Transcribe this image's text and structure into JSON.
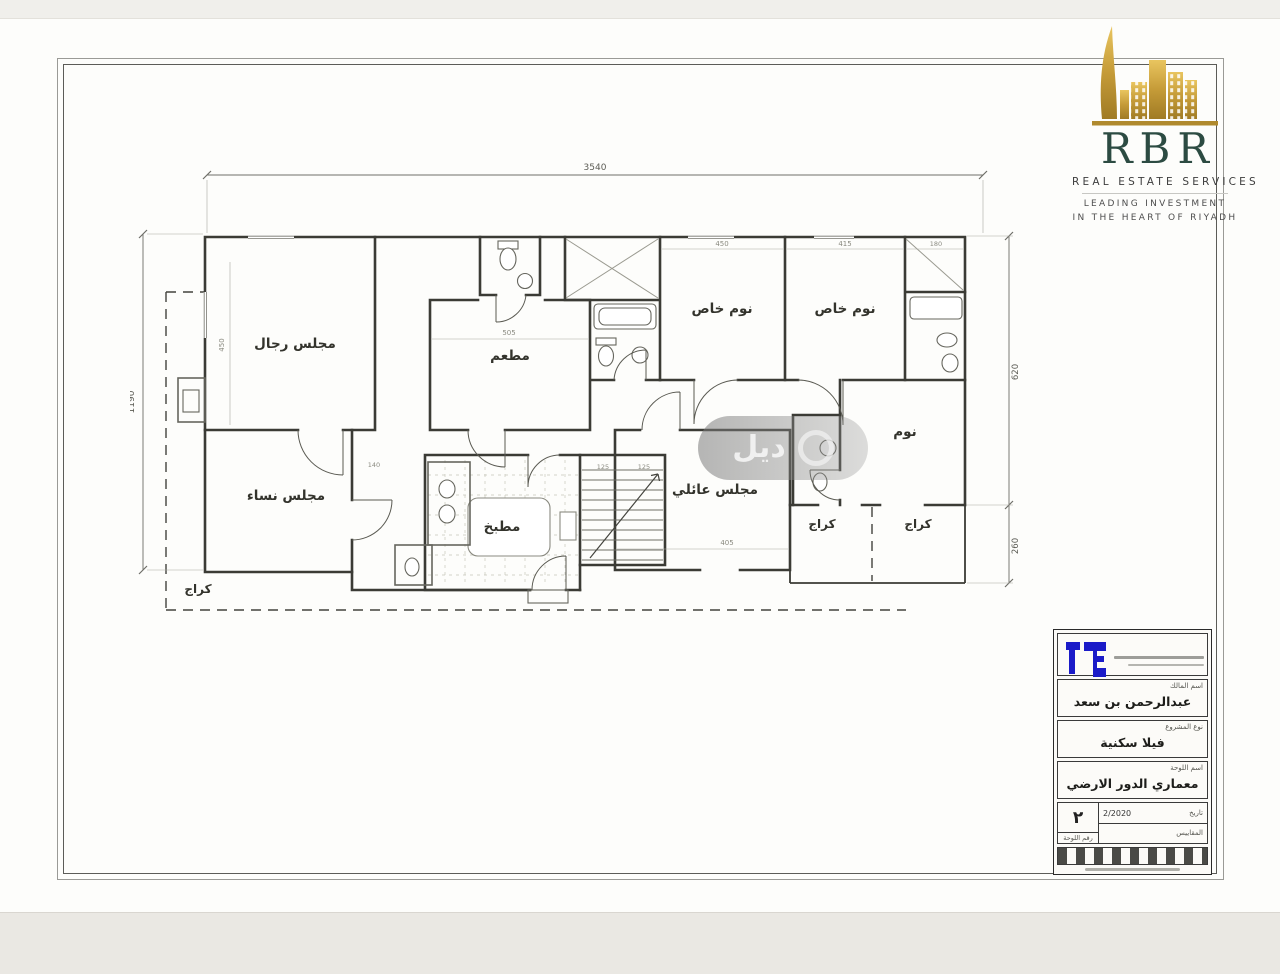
{
  "logo": {
    "brand": "RBR",
    "line1": "REAL ESTATE SERVICES",
    "line2": "LEADING INVESTMENT",
    "line3": "IN THE HEART OF RIYADH"
  },
  "watermark": {
    "text": "ديل"
  },
  "plan": {
    "rooms": [
      {
        "label": "مجلس رجال"
      },
      {
        "label": "مطعم"
      },
      {
        "label": "نوم خاص"
      },
      {
        "label": "نوم خاص"
      },
      {
        "label": "نوم"
      },
      {
        "label": "مجلس عائلي"
      },
      {
        "label": "مطبخ"
      },
      {
        "label": "مجلس نساء"
      },
      {
        "label": "كراج"
      },
      {
        "label": "كراج"
      },
      {
        "label": "كراج"
      }
    ],
    "dims": {
      "overall_width": "3540",
      "overall_depth": "1190",
      "right_upper": "620",
      "right_lower": "260",
      "interior": [
        "450",
        "415",
        "180",
        "505",
        "405",
        "125",
        "125",
        "450",
        "140"
      ]
    }
  },
  "titleblock": {
    "owner_label": "اسم المالك",
    "owner": "عبدالرحمن بن سعد",
    "project_label": "نوع المشروع",
    "project": "فيلا سكنية",
    "sheet_label": "اسم اللوحة",
    "sheet": "معماري الدور الارضي",
    "date_label": "تاريخ",
    "date": "2/2020",
    "sheet_number": "٢",
    "scale_label": "المقاييس",
    "sheet_no_label": "رقم اللوحة"
  }
}
